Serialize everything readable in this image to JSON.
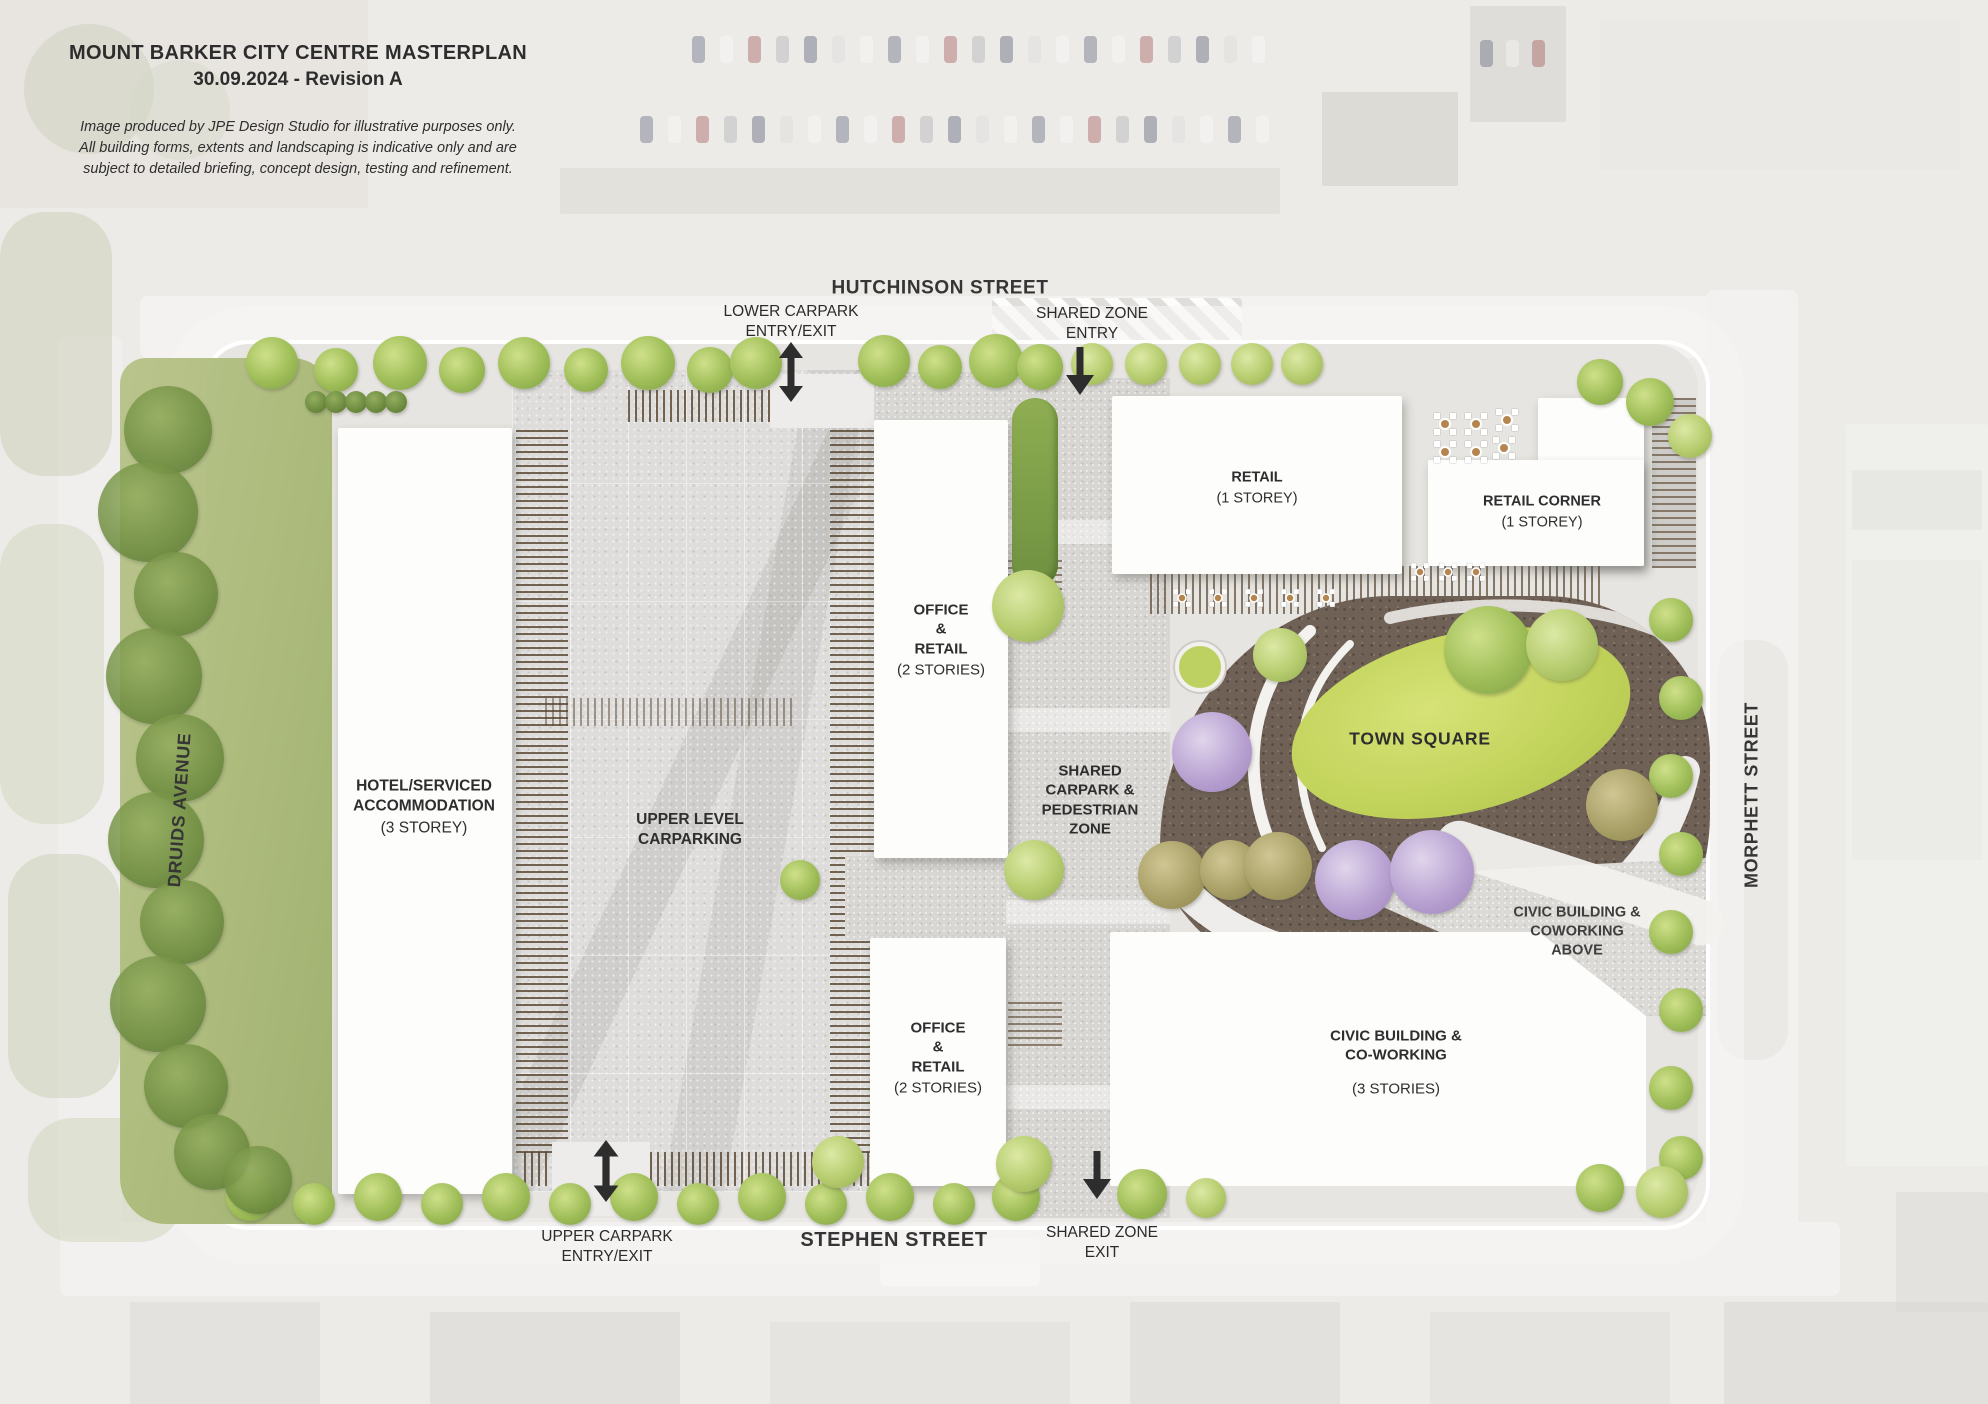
{
  "palette": {
    "lawn_green": "#c3d45c",
    "tree_green": "#9fbe58",
    "tree_purple": "#b9a3d2",
    "tree_olive": "#a89f66",
    "bed_brown": "#6f6156",
    "timber_batten": "#6f5b3e",
    "paving": "#d9d7d3",
    "text": "#2e2e2e"
  },
  "title_block": {
    "title": "MOUNT BARKER CITY CENTRE MASTERPLAN",
    "revision": "30.09.2024 - Revision A",
    "disclaimer": "Image produced by JPE Design Studio for illustrative purposes only.\nAll building forms, extents and landscaping is indicative only and are\nsubject to detailed briefing, concept design, testing and refinement."
  },
  "streets": {
    "hutchinson": "HUTCHINSON STREET",
    "stephen": "STEPHEN STREET",
    "druids": "DRUIDS AVENUE",
    "morphett": "MORPHETT STREET"
  },
  "access": {
    "lower_carpark": "LOWER CARPARK\nENTRY/EXIT",
    "shared_entry": "SHARED ZONE\nENTRY",
    "upper_carpark": "UPPER CARPARK\nENTRY/EXIT",
    "shared_exit": "SHARED ZONE\nEXIT"
  },
  "areas": {
    "hotel": {
      "name": "HOTEL/SERVICED\nACCOMMODATION",
      "sub": "(3 STOREY)"
    },
    "upper_carpark": {
      "name": "UPPER LEVEL\nCARPARKING",
      "sub": ""
    },
    "office_north": {
      "name": "OFFICE\n&\nRETAIL",
      "sub": "(2 STORIES)"
    },
    "office_south": {
      "name": "OFFICE\n&\nRETAIL",
      "sub": "(2 STORIES)"
    },
    "retail": {
      "name": "RETAIL",
      "sub": "(1 STOREY)"
    },
    "retail_corner": {
      "name": "RETAIL CORNER",
      "sub": "(1 STOREY)"
    },
    "town_square": {
      "name": "TOWN SQUARE",
      "sub": ""
    },
    "shared_zone": {
      "name": "SHARED\nCARPARK &\nPEDESTRIAN\nZONE",
      "sub": ""
    },
    "civic_above": {
      "name": "CIVIC BUILDING &\nCOWORKING\nABOVE",
      "sub": ""
    },
    "civic": {
      "name": "CIVIC BUILDING &\nCO-WORKING",
      "sub": "(3 STORIES)"
    }
  }
}
